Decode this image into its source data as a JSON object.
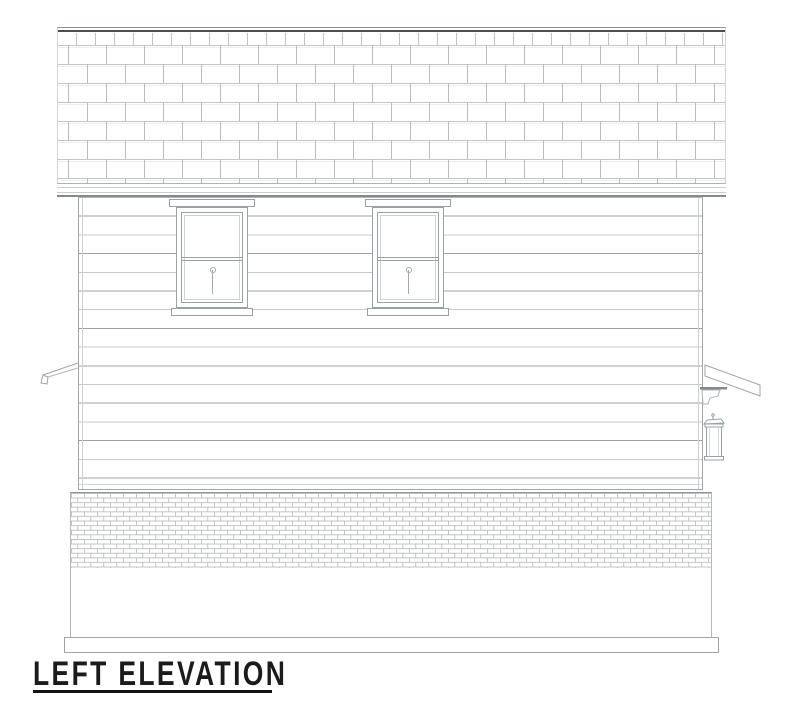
{
  "title": {
    "text": "LEFT ELEVATION"
  },
  "palette": {
    "background": "#ffffff",
    "ink": "#1b1b1b",
    "ridge_dark": "#4b4f52",
    "line_strong": "#85898c",
    "line_medium": "#9aa0a4",
    "line_light": "#c3c7c9",
    "line_faint": "#e6e8e9"
  },
  "elements": {
    "roof": "staggered shingle roof slope with dark ridge cap",
    "fascia": "horizontal eave fascia band",
    "siding": "horizontal lap siding wall with corner trim",
    "window_left": "double-hung window with head trim and sill",
    "window_right": "double-hung window with head trim and sill",
    "left_porch_eave": "porch eave profile projecting from left wall",
    "right_porch_eave": "porch eave profile with gutter and bracket at right wall",
    "wall_lantern": "exterior wall lantern light fixture",
    "brick_wainscot": "brick veneer skirt",
    "foundation": "plain foundation wall",
    "base_board": "projecting base board at grade"
  }
}
